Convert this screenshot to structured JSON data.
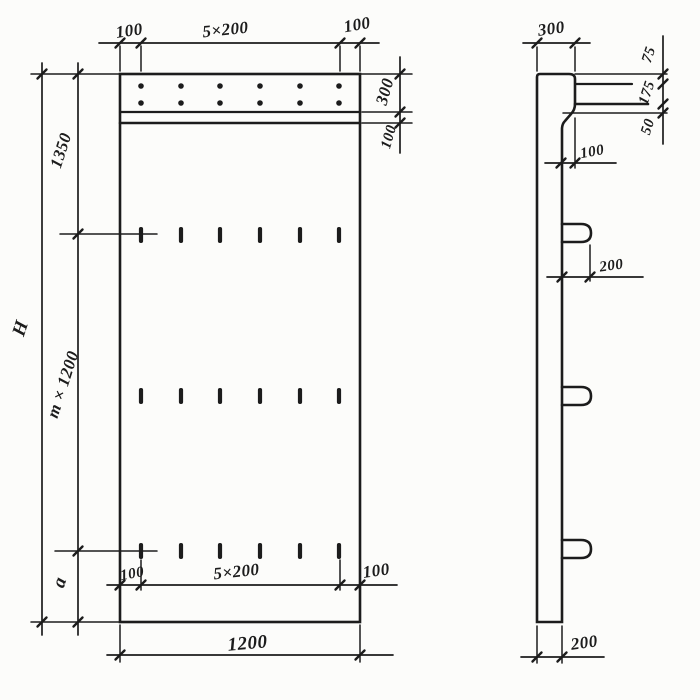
{
  "front": {
    "top": {
      "left": "100",
      "span": "5×200",
      "right": "100"
    },
    "side_right": {
      "band": "300",
      "ledge": "100"
    },
    "left": {
      "total": "H",
      "upper": "1350",
      "middle": "m × 1200",
      "lower": "a"
    },
    "inner_bottom": {
      "left": "100",
      "span": "5×200",
      "right": "100"
    },
    "bottom": {
      "width": "1200"
    }
  },
  "side": {
    "top": {
      "depth": "300"
    },
    "right": {
      "upper": "75",
      "middle": "175",
      "lower": "50"
    },
    "step": "100",
    "loop_offset": "200",
    "bottom_thickness": "200"
  },
  "colors": {
    "ink": "#1c1c1c",
    "paper": "#fcfcfa"
  }
}
